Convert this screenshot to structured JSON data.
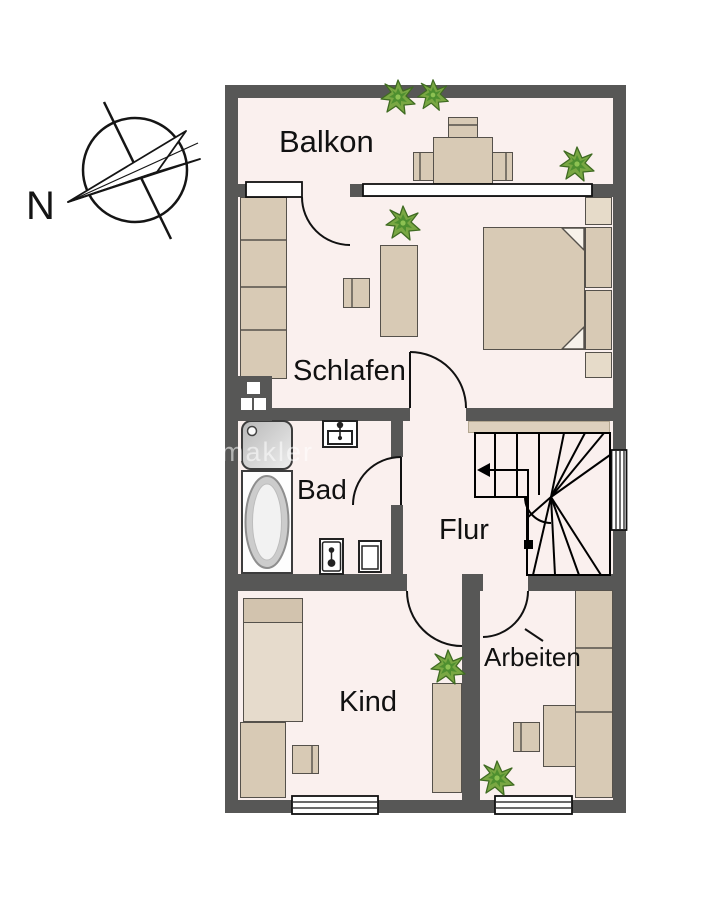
{
  "document": {
    "type": "apartment-floor-plan"
  },
  "compass": {
    "label": "N"
  },
  "rooms": {
    "balkon": {
      "label": "Balkon"
    },
    "schlafen": {
      "label": "Schlafen"
    },
    "bad": {
      "label": "Bad"
    },
    "flur": {
      "label": "Flur"
    },
    "kind": {
      "label": "Kind"
    },
    "arbeiten": {
      "label": "Arbeiten"
    }
  },
  "watermark": {
    "text": "makler"
  },
  "icons": {
    "compass": "compass-north-arrow",
    "plant": "potted-plant",
    "stairs": "winder-staircase-with-direction-arrow",
    "chimney": "chimney-shaft",
    "bath": [
      "shower",
      "bathtub",
      "sink",
      "toilet",
      "bidet"
    ]
  },
  "colors": {
    "background": "#ffffff",
    "wall": "#575756",
    "floor": "#faf0ee",
    "furniture": "#d8cab5",
    "furniture_light": "#e6dbc9",
    "landing": "#ddd0bd",
    "plant_green": "#6fa83e",
    "line": "#111111"
  }
}
